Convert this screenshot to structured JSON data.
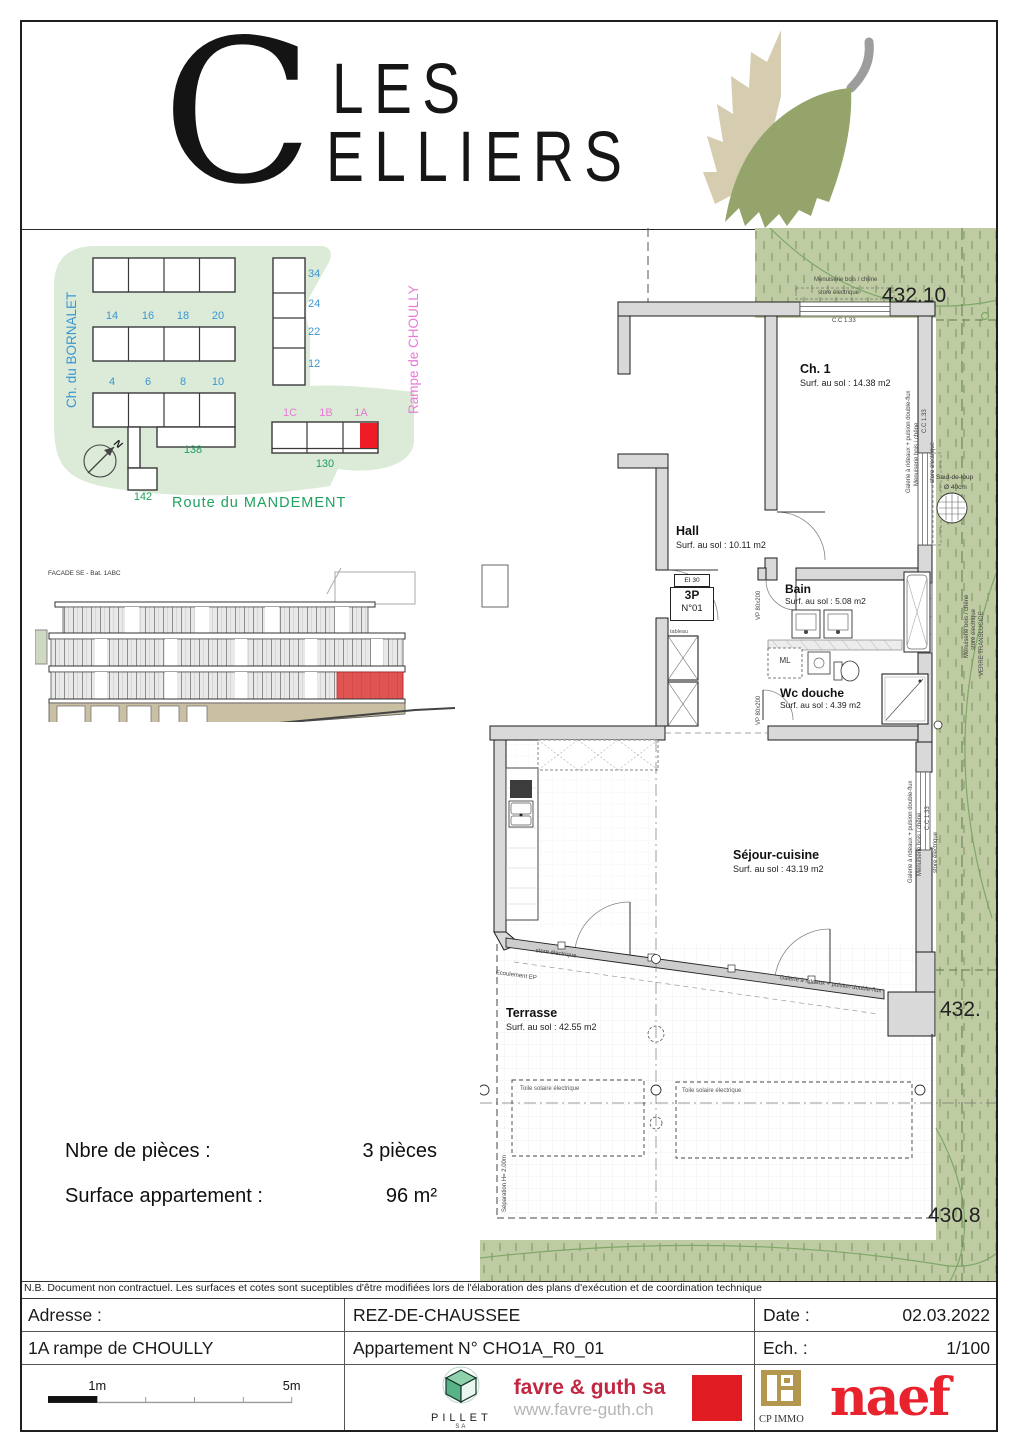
{
  "header": {
    "brand_initial": "C",
    "brand_line1": "LES",
    "brand_line2": "ELLIERS"
  },
  "site_plan": {
    "street_left": "Ch. du BORNALET",
    "street_right": "Rampe de CHOULLY",
    "street_bottom": "Route du MANDEMENT",
    "row_b_labels": [
      "14",
      "16",
      "18",
      "20"
    ],
    "row_c_labels": [
      "4",
      "6",
      "8",
      "10"
    ],
    "col_labels": [
      "34",
      "24",
      "22",
      "12"
    ],
    "unit_labels": [
      "1C",
      "1B",
      "1A"
    ],
    "num_138": "138",
    "num_130": "130",
    "num_142": "142",
    "north": "N"
  },
  "elevation": {
    "caption": "FACADE SE - Bat. 1ABC"
  },
  "plan": {
    "level_top": "432.10",
    "level_right": "432.",
    "level_bottom": "430.8",
    "rooms": {
      "ch1": {
        "name": "Ch. 1",
        "area": "Surf. au sol : 14.38 m2"
      },
      "hall": {
        "name": "Hall",
        "area": "Surf. au sol : 10.11 m2"
      },
      "bain": {
        "name": "Bain",
        "area": "Surf. au sol : 5.08 m2"
      },
      "wc": {
        "name": "Wc douche",
        "area": "Surf. au sol : 4.39 m2"
      },
      "sejour": {
        "name": "Séjour-cuisine",
        "area": "Surf. au sol : 43.19 m2"
      },
      "terrasse": {
        "name": "Terrasse",
        "area": "Surf. au sol : 42.55 m2"
      }
    },
    "annotations": {
      "door_tag_fire": "EI 30",
      "door_tag_type": "3P",
      "door_tag_num": "N°01",
      "ml": "ML",
      "tableau": "tableau",
      "vp_door": "VP 80x200",
      "store": "store électrique",
      "menuiserie": "Menuiserie bois / chêne",
      "cc": "C.C 1.33",
      "galerie": "Galerie à rideaux + pulsion double-flux",
      "verre": "VERRE TRANSLUCIDE",
      "saut_de_loup_1": "Saut-de-loup",
      "saut_de_loup_2": "Ø 40cm",
      "ecoulement": "Ecoulement EP",
      "toile": "Toile solaire électrique",
      "separation": "Séparation H= 2.00m"
    }
  },
  "summary": {
    "rooms_label": "Nbre de pièces :",
    "rooms_value": "3 pièces",
    "surface_label": "Surface appartement :",
    "surface_value": "96 m²"
  },
  "disclaimer": "N.B. Document non contractuel. Les surfaces et cotes sont suceptibles d'être modifiées lors de l'élaboration des plans d'exécution et de coordination technique",
  "title_block": {
    "address_label": "Adresse :",
    "address_value": "1A rampe de CHOULLY",
    "floor": "REZ-DE-CHAUSSEE",
    "apartment": "Appartement N° CHO1A_R0_01",
    "date_label": "Date :",
    "date_value": "02.03.2022",
    "scale_label": "Ech. :",
    "scale_value": "1/100"
  },
  "footer_logos": {
    "scale_1m": "1m",
    "scale_5m": "5m",
    "pillet": "PILLET",
    "pillet_sa": "SA",
    "favre": "favre & guth sa",
    "favre_url": "www.favre-guth.ch",
    "cp_immo": "CP IMMO",
    "naef": "naef"
  },
  "colors": {
    "site_green": "#dcead8",
    "plan_green": "#bfcba3",
    "label_blue": "#3b96d2",
    "label_pink": "#e87ad6",
    "label_green": "#21a05f",
    "highlight_red": "#ee1c25",
    "favre_red": "#c22741",
    "naef_red": "#e8232e",
    "cp_gold": "#b3974f"
  }
}
